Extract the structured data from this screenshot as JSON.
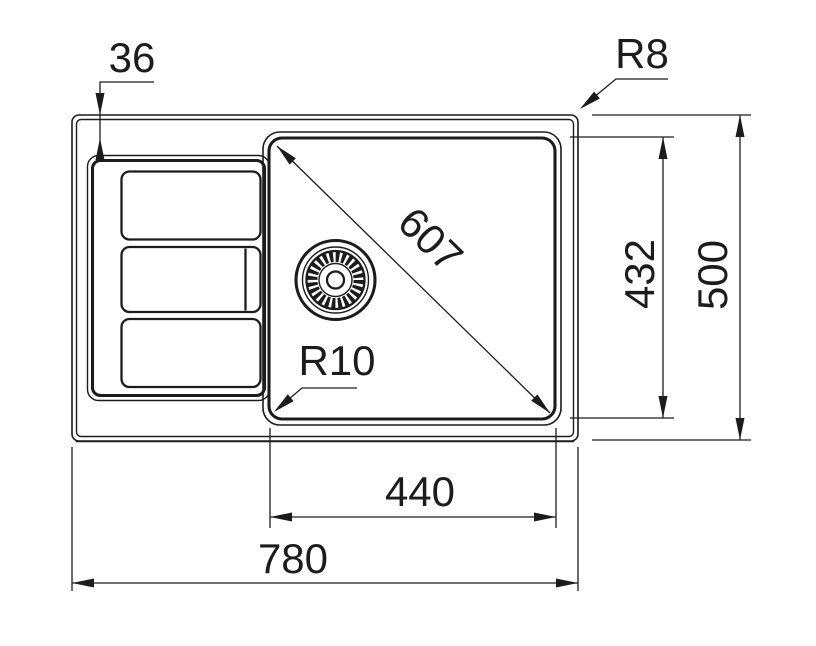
{
  "drawing_title": "Kitchen sink top-view dimension drawing",
  "colors": {
    "background": "#ffffff",
    "line": "#1c1c1c"
  },
  "dims": {
    "drainer_top_offset": "36",
    "rim_corner_radius": "R8",
    "bowl_diagonal": "607",
    "bowl_front_to_back": "432",
    "overall_front_to_back": "500",
    "bowl_corner_radius": "R10",
    "bowl_width": "440",
    "overall_width": "780"
  }
}
